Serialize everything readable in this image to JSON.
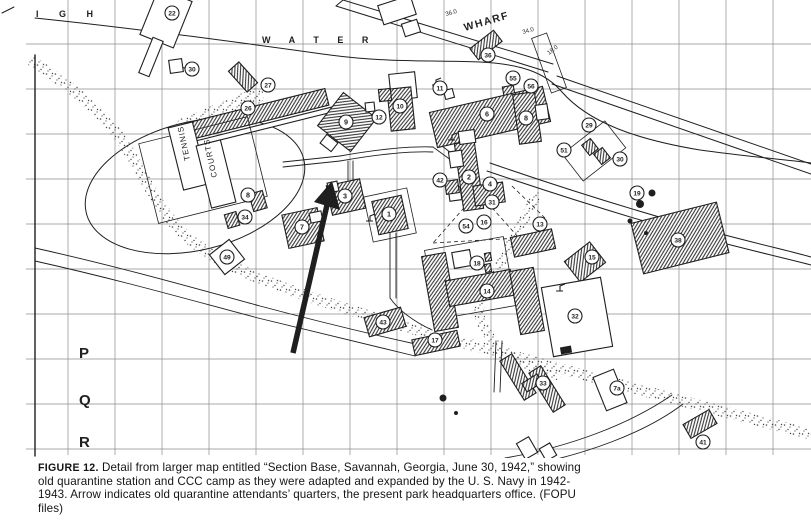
{
  "figure": {
    "caption_label": "FIGURE 12.",
    "caption_text": " Detail from larger map entitled “Section Base, Savannah, Georgia, June 30, 1942,” showing old quarantine station and CCC camp as they were adapted and expanded by the U. S. Navy in 1942-1943. Arrow indicates old quarantine attendants’ quarters, the present park headquarters office. (FOPU files)"
  },
  "map": {
    "width": 811,
    "height": 458,
    "colors": {
      "ink": "#1f1f1f",
      "grid": "#8c8c8c",
      "paper": "#ffffff",
      "hatch": "#2b2b2b",
      "stipple": "#474747"
    },
    "grid": {
      "vx_start": 68,
      "vx_step": 47,
      "vx_end": 800,
      "hy_start": 44,
      "hy_step": 45,
      "hy_end": 449
    },
    "texts": [
      {
        "t": "I G H",
        "x": 36,
        "y": 17,
        "s": 9,
        "ls": 9,
        "b": 1
      },
      {
        "t": "W A T E R",
        "x": 262,
        "y": 43,
        "s": 9,
        "ls": 8,
        "b": 1
      },
      {
        "t": "36.0",
        "x": 446,
        "y": 16,
        "s": 6,
        "rot": -16
      },
      {
        "t": "WHARF",
        "x": 465,
        "y": 31,
        "s": 10.5,
        "rot": -16,
        "b": 1,
        "ls": 1.5
      },
      {
        "t": "34.0",
        "x": 523,
        "y": 34,
        "s": 6,
        "rot": -16
      },
      {
        "t": "18.0",
        "x": 549,
        "y": 55,
        "s": 6,
        "rot": -38
      },
      {
        "t": "P",
        "x": 79,
        "y": 358,
        "s": 15,
        "b": 1
      },
      {
        "t": "Q",
        "x": 79,
        "y": 405,
        "s": 15,
        "b": 1
      },
      {
        "t": "R",
        "x": 79,
        "y": 447,
        "s": 15,
        "b": 1
      },
      {
        "t": "TENNIS",
        "x": 190,
        "y": 160,
        "s": 8,
        "rot": -102,
        "ls": 1
      },
      {
        "t": "COURTS",
        "x": 217,
        "y": 177,
        "s": 8,
        "rot": -102,
        "ls": 1
      }
    ],
    "markers": [
      {
        "n": "22",
        "x": 172,
        "y": 13
      },
      {
        "n": "30",
        "x": 192,
        "y": 69
      },
      {
        "n": "27",
        "x": 268,
        "y": 85
      },
      {
        "n": "26",
        "x": 248,
        "y": 108
      },
      {
        "n": "36",
        "x": 488,
        "y": 55
      },
      {
        "n": "55",
        "x": 513,
        "y": 78
      },
      {
        "n": "56",
        "x": 531,
        "y": 86
      },
      {
        "n": "11",
        "x": 440,
        "y": 88
      },
      {
        "n": "10",
        "x": 400,
        "y": 106
      },
      {
        "n": "12",
        "x": 379,
        "y": 117
      },
      {
        "n": "9",
        "x": 346,
        "y": 122
      },
      {
        "n": "6",
        "x": 487,
        "y": 114
      },
      {
        "n": "8",
        "x": 526,
        "y": 118
      },
      {
        "n": "29",
        "x": 589,
        "y": 125
      },
      {
        "n": "51",
        "x": 564,
        "y": 150
      },
      {
        "n": "30",
        "x": 620,
        "y": 159
      },
      {
        "n": "19",
        "x": 637,
        "y": 193
      },
      {
        "n": "38",
        "x": 678,
        "y": 240
      },
      {
        "n": "42",
        "x": 440,
        "y": 180
      },
      {
        "n": "2",
        "x": 469,
        "y": 177
      },
      {
        "n": "4",
        "x": 490,
        "y": 184
      },
      {
        "n": "31",
        "x": 492,
        "y": 202
      },
      {
        "n": "54",
        "x": 466,
        "y": 226
      },
      {
        "n": "16",
        "x": 484,
        "y": 222
      },
      {
        "n": "13",
        "x": 540,
        "y": 224
      },
      {
        "n": "18",
        "x": 477,
        "y": 263
      },
      {
        "n": "15",
        "x": 592,
        "y": 257
      },
      {
        "n": "14",
        "x": 487,
        "y": 291
      },
      {
        "n": "32",
        "x": 575,
        "y": 316
      },
      {
        "n": "17",
        "x": 435,
        "y": 340
      },
      {
        "n": "43",
        "x": 383,
        "y": 322
      },
      {
        "n": "7",
        "x": 302,
        "y": 227
      },
      {
        "n": "3",
        "x": 345,
        "y": 196
      },
      {
        "n": "1",
        "x": 389,
        "y": 214
      },
      {
        "n": "8",
        "x": 248,
        "y": 195
      },
      {
        "n": "34",
        "x": 245,
        "y": 217
      },
      {
        "n": "49",
        "x": 227,
        "y": 257
      },
      {
        "n": "33",
        "x": 543,
        "y": 383
      },
      {
        "n": "7a",
        "x": 617,
        "y": 388
      },
      {
        "n": "41",
        "x": 703,
        "y": 442
      }
    ],
    "buildings": [
      [
        166,
        18,
        36,
        50,
        22,
        "w"
      ],
      [
        151,
        57,
        11,
        38,
        22,
        "w"
      ],
      [
        176,
        66,
        13,
        13,
        -8,
        "w"
      ],
      [
        243,
        77,
        14,
        28,
        -42,
        "h"
      ],
      [
        258,
        114,
        142,
        17,
        -14,
        "h"
      ],
      [
        262,
        127,
        148,
        5,
        -14,
        "w"
      ],
      [
        203,
        170,
        112,
        82,
        -14,
        "n"
      ],
      [
        188,
        156,
        25,
        64,
        -14,
        "w"
      ],
      [
        216,
        174,
        25,
        64,
        -14,
        "w"
      ],
      [
        347,
        122,
        42,
        42,
        38,
        "h"
      ],
      [
        329,
        143,
        14,
        11,
        38,
        "w"
      ],
      [
        397,
        10,
        34,
        20,
        -18,
        "w"
      ],
      [
        411,
        28,
        16,
        13,
        -18,
        "w"
      ],
      [
        449,
        94,
        9,
        9,
        -15,
        "w"
      ],
      [
        403,
        86,
        26,
        26,
        -6,
        "w"
      ],
      [
        401,
        109,
        24,
        42,
        -6,
        "h"
      ],
      [
        385,
        95,
        12,
        12,
        -6,
        "h"
      ],
      [
        370,
        107,
        9,
        9,
        -6,
        "w"
      ],
      [
        486,
        45,
        30,
        14,
        -38,
        "h"
      ],
      [
        549,
        63,
        16,
        58,
        -20,
        "n"
      ],
      [
        509,
        93,
        11,
        14,
        -10,
        "h"
      ],
      [
        524,
        99,
        9,
        9,
        -10,
        "h"
      ],
      [
        490,
        117,
        116,
        36,
        -13,
        "h"
      ],
      [
        527,
        118,
        22,
        50,
        -8,
        "h"
      ],
      [
        542,
        112,
        12,
        15,
        -8,
        "w"
      ],
      [
        594,
        151,
        54,
        34,
        -38,
        "n"
      ],
      [
        590,
        147,
        11,
        13,
        -38,
        "h"
      ],
      [
        602,
        156,
        11,
        13,
        -38,
        "h"
      ],
      [
        680,
        238,
        88,
        52,
        -14,
        "h"
      ],
      [
        469,
        176,
        20,
        68,
        -8,
        "h"
      ],
      [
        456,
        159,
        13,
        16,
        -8,
        "w"
      ],
      [
        455,
        194,
        12,
        13,
        -8,
        "w"
      ],
      [
        467,
        137,
        16,
        13,
        -8,
        "w"
      ],
      [
        489,
        194,
        30,
        20,
        -8,
        "h"
      ],
      [
        452,
        187,
        13,
        13,
        -8,
        "h"
      ],
      [
        533,
        243,
        42,
        20,
        -12,
        "h"
      ],
      [
        585,
        262,
        32,
        26,
        -38,
        "h"
      ],
      [
        470,
        278,
        80,
        70,
        -10,
        "n"
      ],
      [
        462,
        259,
        18,
        16,
        -10,
        "w"
      ],
      [
        488,
        257,
        6,
        8,
        -10,
        "h"
      ],
      [
        488,
        268,
        6,
        8,
        -10,
        "h"
      ],
      [
        440,
        292,
        24,
        76,
        -10,
        "h"
      ],
      [
        480,
        288,
        66,
        26,
        -10,
        "h"
      ],
      [
        527,
        301,
        24,
        64,
        -10,
        "h"
      ],
      [
        577,
        317,
        60,
        70,
        -10,
        "w"
      ],
      [
        566,
        350,
        10,
        6,
        -10,
        "b"
      ],
      [
        436,
        343,
        46,
        16,
        -12,
        "h"
      ],
      [
        385,
        322,
        38,
        20,
        -16,
        "h"
      ],
      [
        303,
        228,
        36,
        34,
        -12,
        "h"
      ],
      [
        316,
        217,
        12,
        10,
        -12,
        "w"
      ],
      [
        346,
        197,
        34,
        30,
        -12,
        "h"
      ],
      [
        333,
        187,
        10,
        10,
        -12,
        "w"
      ],
      [
        390,
        215,
        44,
        46,
        -12,
        "n"
      ],
      [
        390,
        215,
        30,
        34,
        -12,
        "h"
      ],
      [
        258,
        201,
        14,
        18,
        -16,
        "h"
      ],
      [
        232,
        220,
        12,
        14,
        -16,
        "h"
      ],
      [
        227,
        257,
        25,
        25,
        -38,
        "w"
      ],
      [
        518,
        377,
        14,
        46,
        -32,
        "h"
      ],
      [
        547,
        389,
        14,
        46,
        -32,
        "h"
      ],
      [
        532,
        383,
        18,
        10,
        -32,
        "h"
      ],
      [
        610,
        390,
        22,
        36,
        -22,
        "w"
      ],
      [
        700,
        424,
        30,
        16,
        -30,
        "h"
      ],
      [
        527,
        448,
        14,
        18,
        -30,
        "w"
      ],
      [
        548,
        452,
        12,
        14,
        -30,
        "w"
      ]
    ],
    "ellipses": [
      [
        195,
        186,
        112,
        64,
        -14
      ]
    ],
    "paths": [
      {
        "d": "M35,18 C150,30 250,44 330,55 C390,63 440,60 480,62 C520,64 545,72 562,92 C590,124 640,140 700,150 C750,157 790,160 811,163",
        "w": 1
      },
      {
        "d": "M343,0 L553,64",
        "w": 1
      },
      {
        "d": "M336,6 L548,72",
        "w": 1
      },
      {
        "d": "M343,0 L336,6",
        "w": 1
      },
      {
        "d": "M557,76 L811,164",
        "w": 1
      },
      {
        "d": "M552,84 L811,174",
        "w": 1
      },
      {
        "d": "M490,163 C545,182 610,203 680,223 C745,241 790,251 811,257",
        "w": 1
      },
      {
        "d": "M487,171 C543,190 608,211 678,231 C743,249 789,259 811,265",
        "w": 1
      },
      {
        "d": "M283,162 L340,156",
        "w": 0.9
      },
      {
        "d": "M283,167 L340,161",
        "w": 0.9
      },
      {
        "d": "M340,156 C380,149 410,146 433,147",
        "w": 0.9
      },
      {
        "d": "M340,161 C380,154 410,151 433,152",
        "w": 0.9
      },
      {
        "d": "M433,147 L459,166",
        "w": 0.9
      },
      {
        "d": "M438,143 L463,162",
        "w": 0.9
      },
      {
        "d": "M348,161 L348,181",
        "w": 0.9
      },
      {
        "d": "M353,161 L353,181",
        "w": 0.9
      },
      {
        "d": "M390,233 L390,298",
        "w": 0.9
      },
      {
        "d": "M396,233 L396,298",
        "w": 0.9
      },
      {
        "d": "M390,298 C400,312 415,322 432,330",
        "w": 0.9
      },
      {
        "d": "M496,341 L494,392",
        "w": 0.9
      },
      {
        "d": "M502,341 L500,392",
        "w": 0.9
      },
      {
        "d": "M35,248 C120,267 190,287 260,306 C320,322 370,334 420,345",
        "w": 0.9
      },
      {
        "d": "M35,261 C120,280 190,300 258,318 C318,333 368,345 415,356",
        "w": 0.9
      },
      {
        "d": "M672,395 C630,424 570,447 505,458",
        "w": 0.9
      },
      {
        "d": "M683,404 C645,433 585,455 520,467",
        "w": 0.9
      },
      {
        "d": "M35,55 L35,456",
        "w": 1.4
      },
      {
        "d": "M2,13 L14,7",
        "w": 1
      },
      {
        "d": "M179,67 L185,68",
        "w": 0.9
      }
    ],
    "dashed": [
      "M478,192 L433,243",
      "M478,192 L519,238",
      "M433,243 L519,238",
      "M512,186 L545,218"
    ],
    "stipple_roads": [
      {
        "d": "M33,62 C80,92 112,122 128,150 C146,180 158,210 186,236 C216,263 262,281 322,301 C400,327 480,347 562,369 C650,393 732,414 811,434",
        "w": 11
      },
      {
        "d": "M184,126 L256,96",
        "w": 16
      },
      {
        "d": "M536,196 C520,230 498,265 481,300 C474,316 486,338 508,354 C522,364 540,371 556,375",
        "w": 10
      }
    ],
    "dots": [
      [
        652,
        193,
        3.5
      ],
      [
        640,
        204,
        4
      ],
      [
        630,
        221,
        2.5
      ],
      [
        646,
        233,
        2
      ],
      [
        443,
        398,
        3.5
      ],
      [
        456,
        413,
        2
      ]
    ],
    "flags": [
      [
        436,
        82
      ],
      [
        452,
        137
      ],
      [
        370,
        218
      ],
      [
        560,
        288
      ]
    ],
    "arrow": {
      "line": "M293,353 L327,205",
      "head": "332,181 340,210 314,202",
      "w": 5.5
    }
  }
}
